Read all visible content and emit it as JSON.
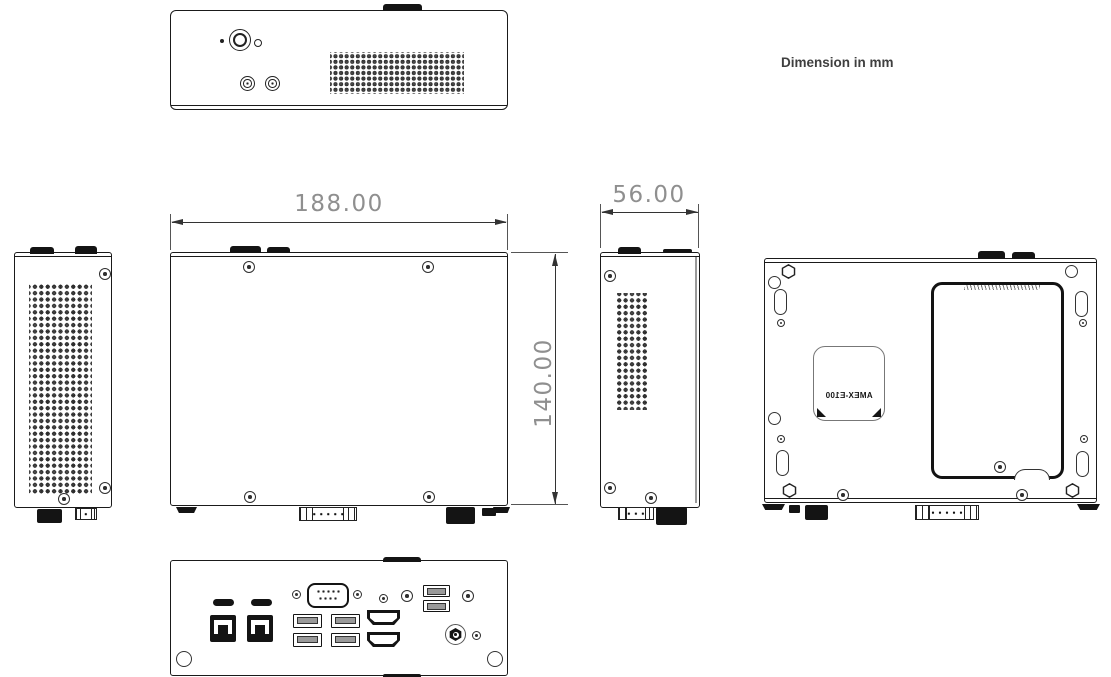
{
  "note": "Dimension in mm",
  "dimensions": {
    "width_mm": "188.00",
    "height_mm": "56.00",
    "depth_mm": "140.00"
  },
  "device": {
    "model_label": "AMEX-E100"
  },
  "colors": {
    "line": "#1a1a1a",
    "dimension_text": "#8f8f8f",
    "note_text": "#3f3f3f",
    "background": "#ffffff"
  },
  "views": {
    "front_panel": {
      "features": [
        "antenna-tab",
        "power-button",
        "power-led",
        "reset-pinhole",
        "audio-jack",
        "audio-jack",
        "vent-grille"
      ]
    },
    "left_side": {
      "features": [
        "antenna-tab",
        "antenna-tab",
        "vent-grille",
        "screw",
        "screw",
        "screw"
      ]
    },
    "top": {
      "features": [
        "antenna-tab",
        "antenna-tab",
        "screw",
        "screw",
        "screw",
        "screw",
        "dsub-edge",
        "dc-jack-edge",
        "feet"
      ]
    },
    "right_side": {
      "features": [
        "antenna-tab",
        "vent-grille",
        "screw",
        "screw",
        "screw",
        "dsub-edge",
        "dc-jack-edge"
      ]
    },
    "bottom": {
      "features": [
        "hex-cutout",
        "mounting-hole",
        "mounting-slot",
        "screw",
        "access-cover",
        "cover-hatch",
        "finger-notch",
        "model-label-plate",
        "feet"
      ]
    },
    "rear_panel": {
      "features": [
        "sim-slot",
        "sim-slot",
        "lan-rj45",
        "lan-rj45",
        "com-db9",
        "usb-a",
        "usb-a",
        "usb-a",
        "usb-a",
        "hdmi",
        "hdmi",
        "usb-a",
        "usb-a",
        "dc-power-jack",
        "thumbscrew-hole",
        "thumbscrew-hole"
      ]
    }
  }
}
